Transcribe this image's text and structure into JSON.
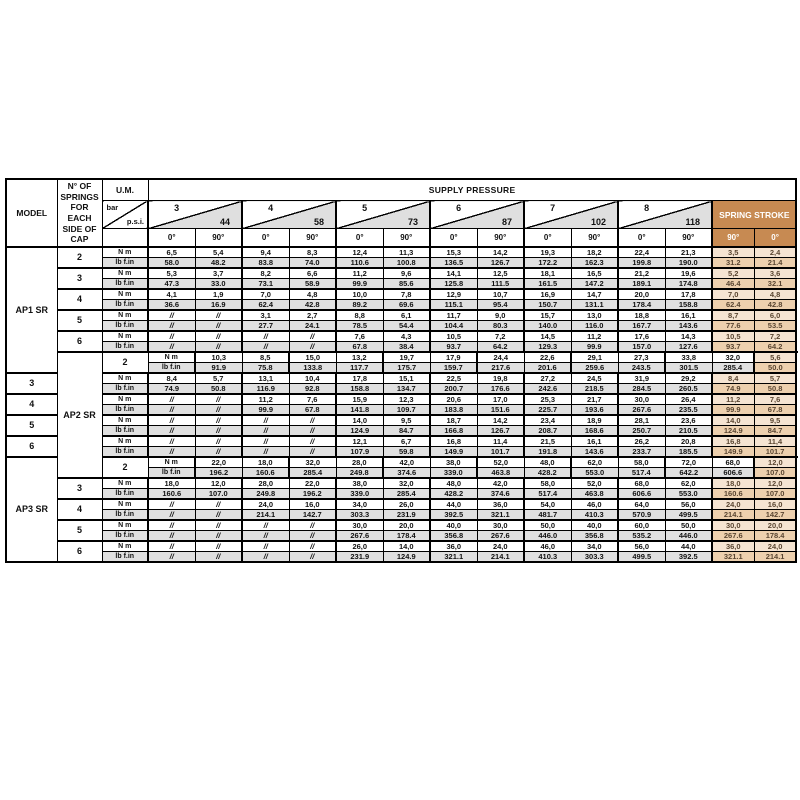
{
  "header": {
    "model": "MODEL",
    "springs": "N° OF SPRINGS FOR EACH SIDE OF CAP",
    "um": "U.M.",
    "bar": "bar",
    "psi": "p.s.i.",
    "supply_pressure": "SUPPLY PRESSURE",
    "spring_stroke": "SPRING STROKE",
    "deg0": "0°",
    "deg90": "90°",
    "stroke_deg": [
      "90°",
      "0°"
    ],
    "pressures": [
      {
        "bar": "3",
        "psi": "44"
      },
      {
        "bar": "4",
        "psi": "58"
      },
      {
        "bar": "5",
        "psi": "73"
      },
      {
        "bar": "6",
        "psi": "87"
      },
      {
        "bar": "7",
        "psi": "102"
      },
      {
        "bar": "8",
        "psi": "118"
      }
    ]
  },
  "units": [
    "N m",
    "lb f.in"
  ],
  "colors": {
    "stroke_header": "#c78a52",
    "stroke_nm_cell": "#f5e4d2",
    "stroke_lb_cell": "#edd0ae",
    "gray_row": "#e0e0e0"
  },
  "models": [
    {
      "name": "AP1 SR",
      "groups": [
        {
          "springs": "2",
          "nm": [
            "6,5",
            "5,4",
            "9,4",
            "8,3",
            "12,4",
            "11,3",
            "15,3",
            "14,2",
            "19,3",
            "18,2",
            "22,4",
            "21,3",
            "3,5",
            "2,4"
          ],
          "lb": [
            "58.0",
            "48.2",
            "83.8",
            "74.0",
            "110.6",
            "100.8",
            "136.5",
            "126.7",
            "172.2",
            "162.3",
            "199.8",
            "190.0",
            "31.2",
            "21.4"
          ]
        },
        {
          "springs": "3",
          "nm": [
            "5,3",
            "3,7",
            "8,2",
            "6,6",
            "11,2",
            "9,6",
            "14,1",
            "12,5",
            "18,1",
            "16,5",
            "21,2",
            "19,6",
            "5,2",
            "3,6"
          ],
          "lb": [
            "47.3",
            "33.0",
            "73.1",
            "58.9",
            "99.9",
            "85.6",
            "125.8",
            "111.5",
            "161.5",
            "147.2",
            "189.1",
            "174.8",
            "46.4",
            "32.1"
          ]
        },
        {
          "springs": "4",
          "nm": [
            "4,1",
            "1,9",
            "7,0",
            "4,8",
            "10,0",
            "7,8",
            "12,9",
            "10,7",
            "16,9",
            "14,7",
            "20,0",
            "17,8",
            "7,0",
            "4,8"
          ],
          "lb": [
            "36.6",
            "16.9",
            "62.4",
            "42.8",
            "89.2",
            "69.6",
            "115.1",
            "95.4",
            "150.7",
            "131.1",
            "178.4",
            "158.8",
            "62.4",
            "42.8"
          ]
        },
        {
          "springs": "5",
          "nm": [
            "//",
            "//",
            "3,1",
            "2,7",
            "8,8",
            "6,1",
            "11,7",
            "9,0",
            "15,7",
            "13,0",
            "18,8",
            "16,1",
            "8,7",
            "6,0"
          ],
          "lb": [
            "//",
            "//",
            "27.7",
            "24.1",
            "78.5",
            "54.4",
            "104.4",
            "80.3",
            "140.0",
            "116.0",
            "167.7",
            "143.6",
            "77.6",
            "53.5"
          ]
        },
        {
          "springs": "6",
          "nm": [
            "//",
            "//",
            "//",
            "//",
            "7,6",
            "4,3",
            "10,5",
            "7,2",
            "14,5",
            "11,2",
            "17,6",
            "14,3",
            "10,5",
            "7,2"
          ],
          "lb": [
            "//",
            "//",
            "//",
            "//",
            "67.8",
            "38.4",
            "93.7",
            "64.2",
            "129.3",
            "99.9",
            "157.0",
            "127.6",
            "93.7",
            "64.2"
          ]
        }
      ]
    },
    {
      "name": "AP2 SR",
      "groups": [
        {
          "springs": "2",
          "nm": [
            "10,3",
            "8,5",
            "15,0",
            "13,2",
            "19,7",
            "17,9",
            "24,4",
            "22,6",
            "29,1",
            "27,3",
            "33,8",
            "32,0",
            "5,6",
            "3,8"
          ],
          "lb": [
            "91.9",
            "75.8",
            "133.8",
            "117.7",
            "175.7",
            "159.7",
            "217.6",
            "201.6",
            "259.6",
            "243.5",
            "301.5",
            "285.4",
            "50.0",
            "33.9"
          ]
        },
        {
          "springs": "3",
          "nm": [
            "8,4",
            "5,7",
            "13,1",
            "10,4",
            "17,8",
            "15,1",
            "22,5",
            "19,8",
            "27,2",
            "24,5",
            "31,9",
            "29,2",
            "8,4",
            "5,7"
          ],
          "lb": [
            "74.9",
            "50.8",
            "116.9",
            "92.8",
            "158.8",
            "134.7",
            "200.7",
            "176.6",
            "242.6",
            "218.5",
            "284.5",
            "260.5",
            "74.9",
            "50.8"
          ]
        },
        {
          "springs": "4",
          "nm": [
            "//",
            "//",
            "11,2",
            "7,6",
            "15,9",
            "12,3",
            "20,6",
            "17,0",
            "25,3",
            "21,7",
            "30,0",
            "26,4",
            "11,2",
            "7,6"
          ],
          "lb": [
            "//",
            "//",
            "99.9",
            "67.8",
            "141.8",
            "109.7",
            "183.8",
            "151.6",
            "225.7",
            "193.6",
            "267.6",
            "235.5",
            "99.9",
            "67.8"
          ]
        },
        {
          "springs": "5",
          "nm": [
            "//",
            "//",
            "//",
            "//",
            "14,0",
            "9,5",
            "18,7",
            "14,2",
            "23,4",
            "18,9",
            "28,1",
            "23,6",
            "14,0",
            "9,5"
          ],
          "lb": [
            "//",
            "//",
            "//",
            "//",
            "124.9",
            "84.7",
            "166.8",
            "126.7",
            "208.7",
            "168.6",
            "250.7",
            "210.5",
            "124.9",
            "84.7"
          ]
        },
        {
          "springs": "6",
          "nm": [
            "//",
            "//",
            "//",
            "//",
            "12,1",
            "6,7",
            "16,8",
            "11,4",
            "21,5",
            "16,1",
            "26,2",
            "20,8",
            "16,8",
            "11,4"
          ],
          "lb": [
            "//",
            "//",
            "//",
            "//",
            "107.9",
            "59.8",
            "149.9",
            "101.7",
            "191.8",
            "143.6",
            "233.7",
            "185.5",
            "149.9",
            "101.7"
          ]
        }
      ]
    },
    {
      "name": "AP3 SR",
      "groups": [
        {
          "springs": "2",
          "nm": [
            "22,0",
            "18,0",
            "32,0",
            "28,0",
            "42,0",
            "38,0",
            "52,0",
            "48,0",
            "62,0",
            "58,0",
            "72,0",
            "68,0",
            "12,0",
            "8,0"
          ],
          "lb": [
            "196.2",
            "160.6",
            "285.4",
            "249.8",
            "374.6",
            "339.0",
            "463.8",
            "428.2",
            "553.0",
            "517.4",
            "642.2",
            "606.6",
            "107.0",
            "71.4"
          ]
        },
        {
          "springs": "3",
          "nm": [
            "18,0",
            "12,0",
            "28,0",
            "22,0",
            "38,0",
            "32,0",
            "48,0",
            "42,0",
            "58,0",
            "52,0",
            "68,0",
            "62,0",
            "18,0",
            "12,0"
          ],
          "lb": [
            "160.6",
            "107.0",
            "249.8",
            "196.2",
            "339.0",
            "285.4",
            "428.2",
            "374.6",
            "517.4",
            "463.8",
            "606.6",
            "553.0",
            "160.6",
            "107.0"
          ]
        },
        {
          "springs": "4",
          "nm": [
            "//",
            "//",
            "24,0",
            "16,0",
            "34,0",
            "26,0",
            "44,0",
            "36,0",
            "54,0",
            "46,0",
            "64,0",
            "56,0",
            "24,0",
            "16,0"
          ],
          "lb": [
            "//",
            "//",
            "214.1",
            "142.7",
            "303.3",
            "231.9",
            "392.5",
            "321.1",
            "481.7",
            "410.3",
            "570.9",
            "499.5",
            "214.1",
            "142.7"
          ]
        },
        {
          "springs": "5",
          "nm": [
            "//",
            "//",
            "//",
            "//",
            "30,0",
            "20,0",
            "40,0",
            "30,0",
            "50,0",
            "40,0",
            "60,0",
            "50,0",
            "30,0",
            "20,0"
          ],
          "lb": [
            "//",
            "//",
            "//",
            "//",
            "267.6",
            "178.4",
            "356.8",
            "267.6",
            "446.0",
            "356.8",
            "535.2",
            "446.0",
            "267.6",
            "178.4"
          ]
        },
        {
          "springs": "6",
          "nm": [
            "//",
            "//",
            "//",
            "//",
            "26,0",
            "14,0",
            "36,0",
            "24,0",
            "46,0",
            "34,0",
            "56,0",
            "44,0",
            "36,0",
            "24,0"
          ],
          "lb": [
            "//",
            "//",
            "//",
            "//",
            "231.9",
            "124.9",
            "321.1",
            "214.1",
            "410.3",
            "303.3",
            "499.5",
            "392.5",
            "321.1",
            "214.1"
          ]
        }
      ]
    }
  ]
}
